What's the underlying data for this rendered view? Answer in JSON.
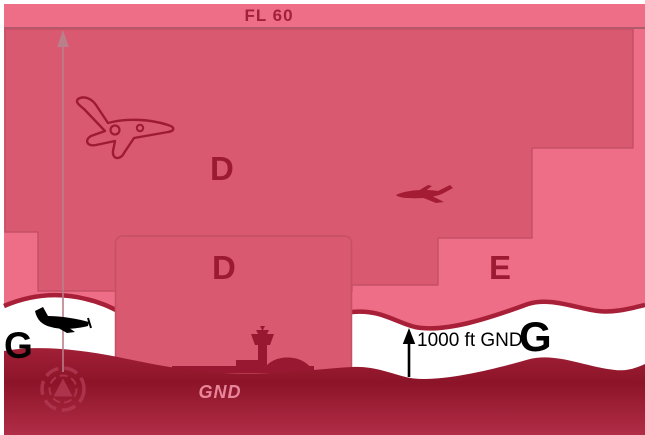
{
  "figure": {
    "title": "airspace-classes-side-view-diagram",
    "labels": {
      "flight_level": "FL 60",
      "class_d_upper": "D",
      "class_d_lower": "D",
      "class_e": "E",
      "class_g_left": "G",
      "class_g_right": "G",
      "agl_height": "1000 ft GND",
      "ground": "GND"
    },
    "colors": {
      "class_e_fill": "#ed6e86",
      "class_d_fill": "#d95971",
      "boundary_stroke": "#c55066",
      "fl60_line": "#ad5c6d",
      "dark_red_text": "#9c1b33",
      "white_band": "#ffffff",
      "band_crest": "#a81f38",
      "ground_top": "#a32138",
      "ground_deep": "#8c1428",
      "ground_bottom": "#b12d47",
      "gnd_text": "#e8859a",
      "black": "#000000"
    },
    "icons": [
      "jet-outline-icon",
      "small-airplane-icon",
      "black-airplane-icon",
      "vor-icon",
      "airport-tower-icon",
      "altitude-arrow-icon",
      "agl-arrow-icon"
    ]
  }
}
